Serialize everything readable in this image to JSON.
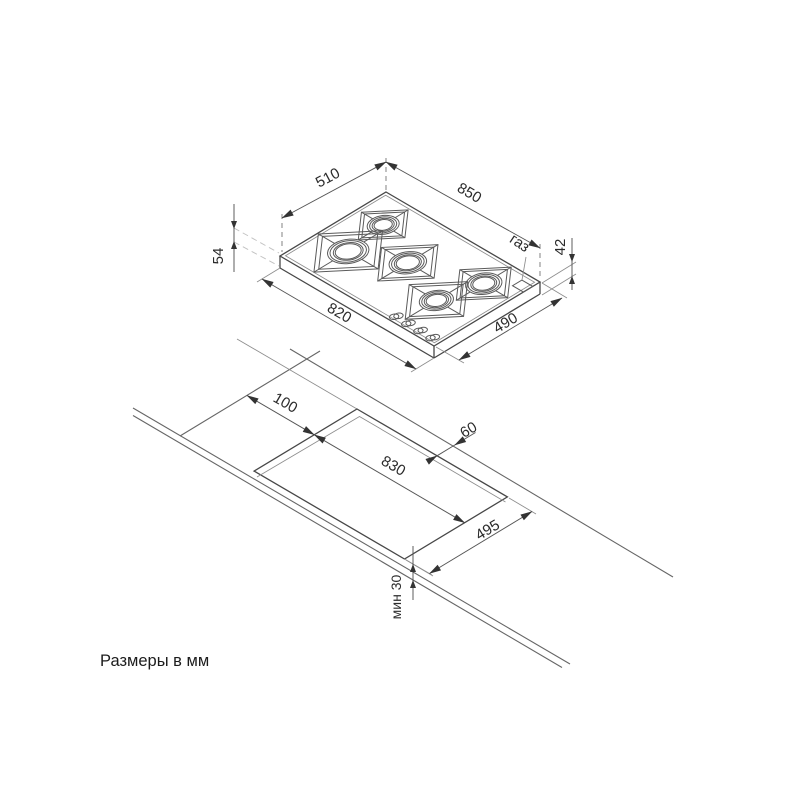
{
  "title": "Размеры в мм",
  "top_view": {
    "label": "hob-isometric-view",
    "width_top": "850",
    "depth_top": "510",
    "width_bottom": "820",
    "depth_bottom": "490",
    "height_total": "54",
    "height_body": "42",
    "gas_label": "газ"
  },
  "cutout_view": {
    "label": "worktop-cutout-view",
    "offset_left": "100",
    "offset_back": "60",
    "cutout_length": "830",
    "cutout_width": "495",
    "front_min": "мин 30"
  },
  "colors": {
    "background": "#ffffff",
    "line": "#5a5a5a",
    "dimension_text": "#2b2b2b"
  }
}
